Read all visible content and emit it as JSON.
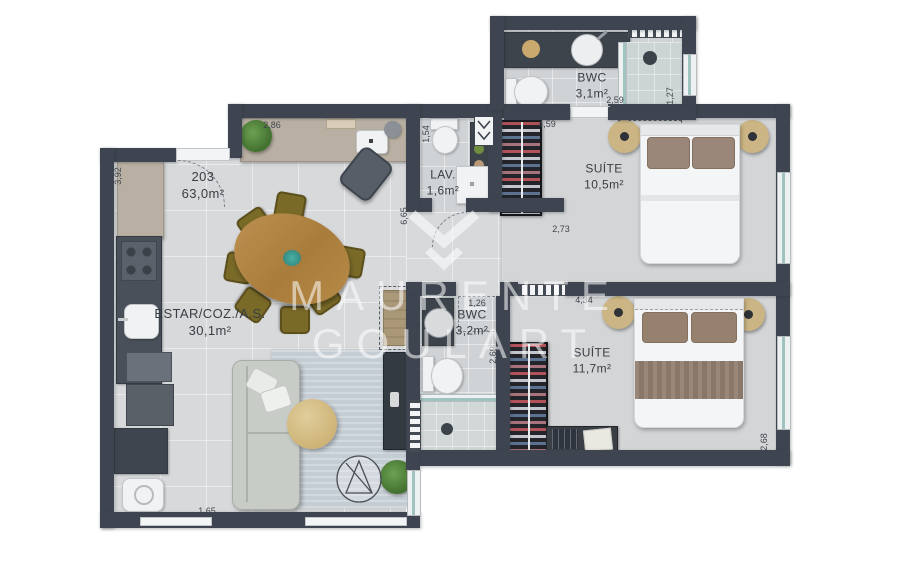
{
  "unit": {
    "number": "203",
    "area": "63,0m²"
  },
  "rooms": [
    {
      "name": "ESTAR/COZ./A.S.",
      "area": "30,1m²"
    },
    {
      "name": "LAV.",
      "area": "1,6m²"
    },
    {
      "name": "BWC",
      "area": "3,1m²"
    },
    {
      "name": "SUÍTE",
      "area": "10,5m²"
    },
    {
      "name": "BWC",
      "area": "3,2m²"
    },
    {
      "name": "SUÍTE",
      "area": "11,7m²"
    }
  ],
  "dims": [
    "2,86",
    "3,92",
    "1,54",
    "4,59",
    "2,59",
    "1,27",
    "6,65",
    "2,73",
    "1,26",
    "4,34",
    "2,69",
    "2,68",
    "1,65"
  ],
  "watermark": {
    "line1": "MAURENTE",
    "line2": "GOULART"
  },
  "colors": {
    "wall": "#3e4550",
    "floor": "#d7d9db",
    "wood": "#b08544",
    "counter": "#b9b0a3",
    "glass": "#9fc4c0",
    "nightstand": "#cbb584",
    "pillow": "#9b8779"
  }
}
